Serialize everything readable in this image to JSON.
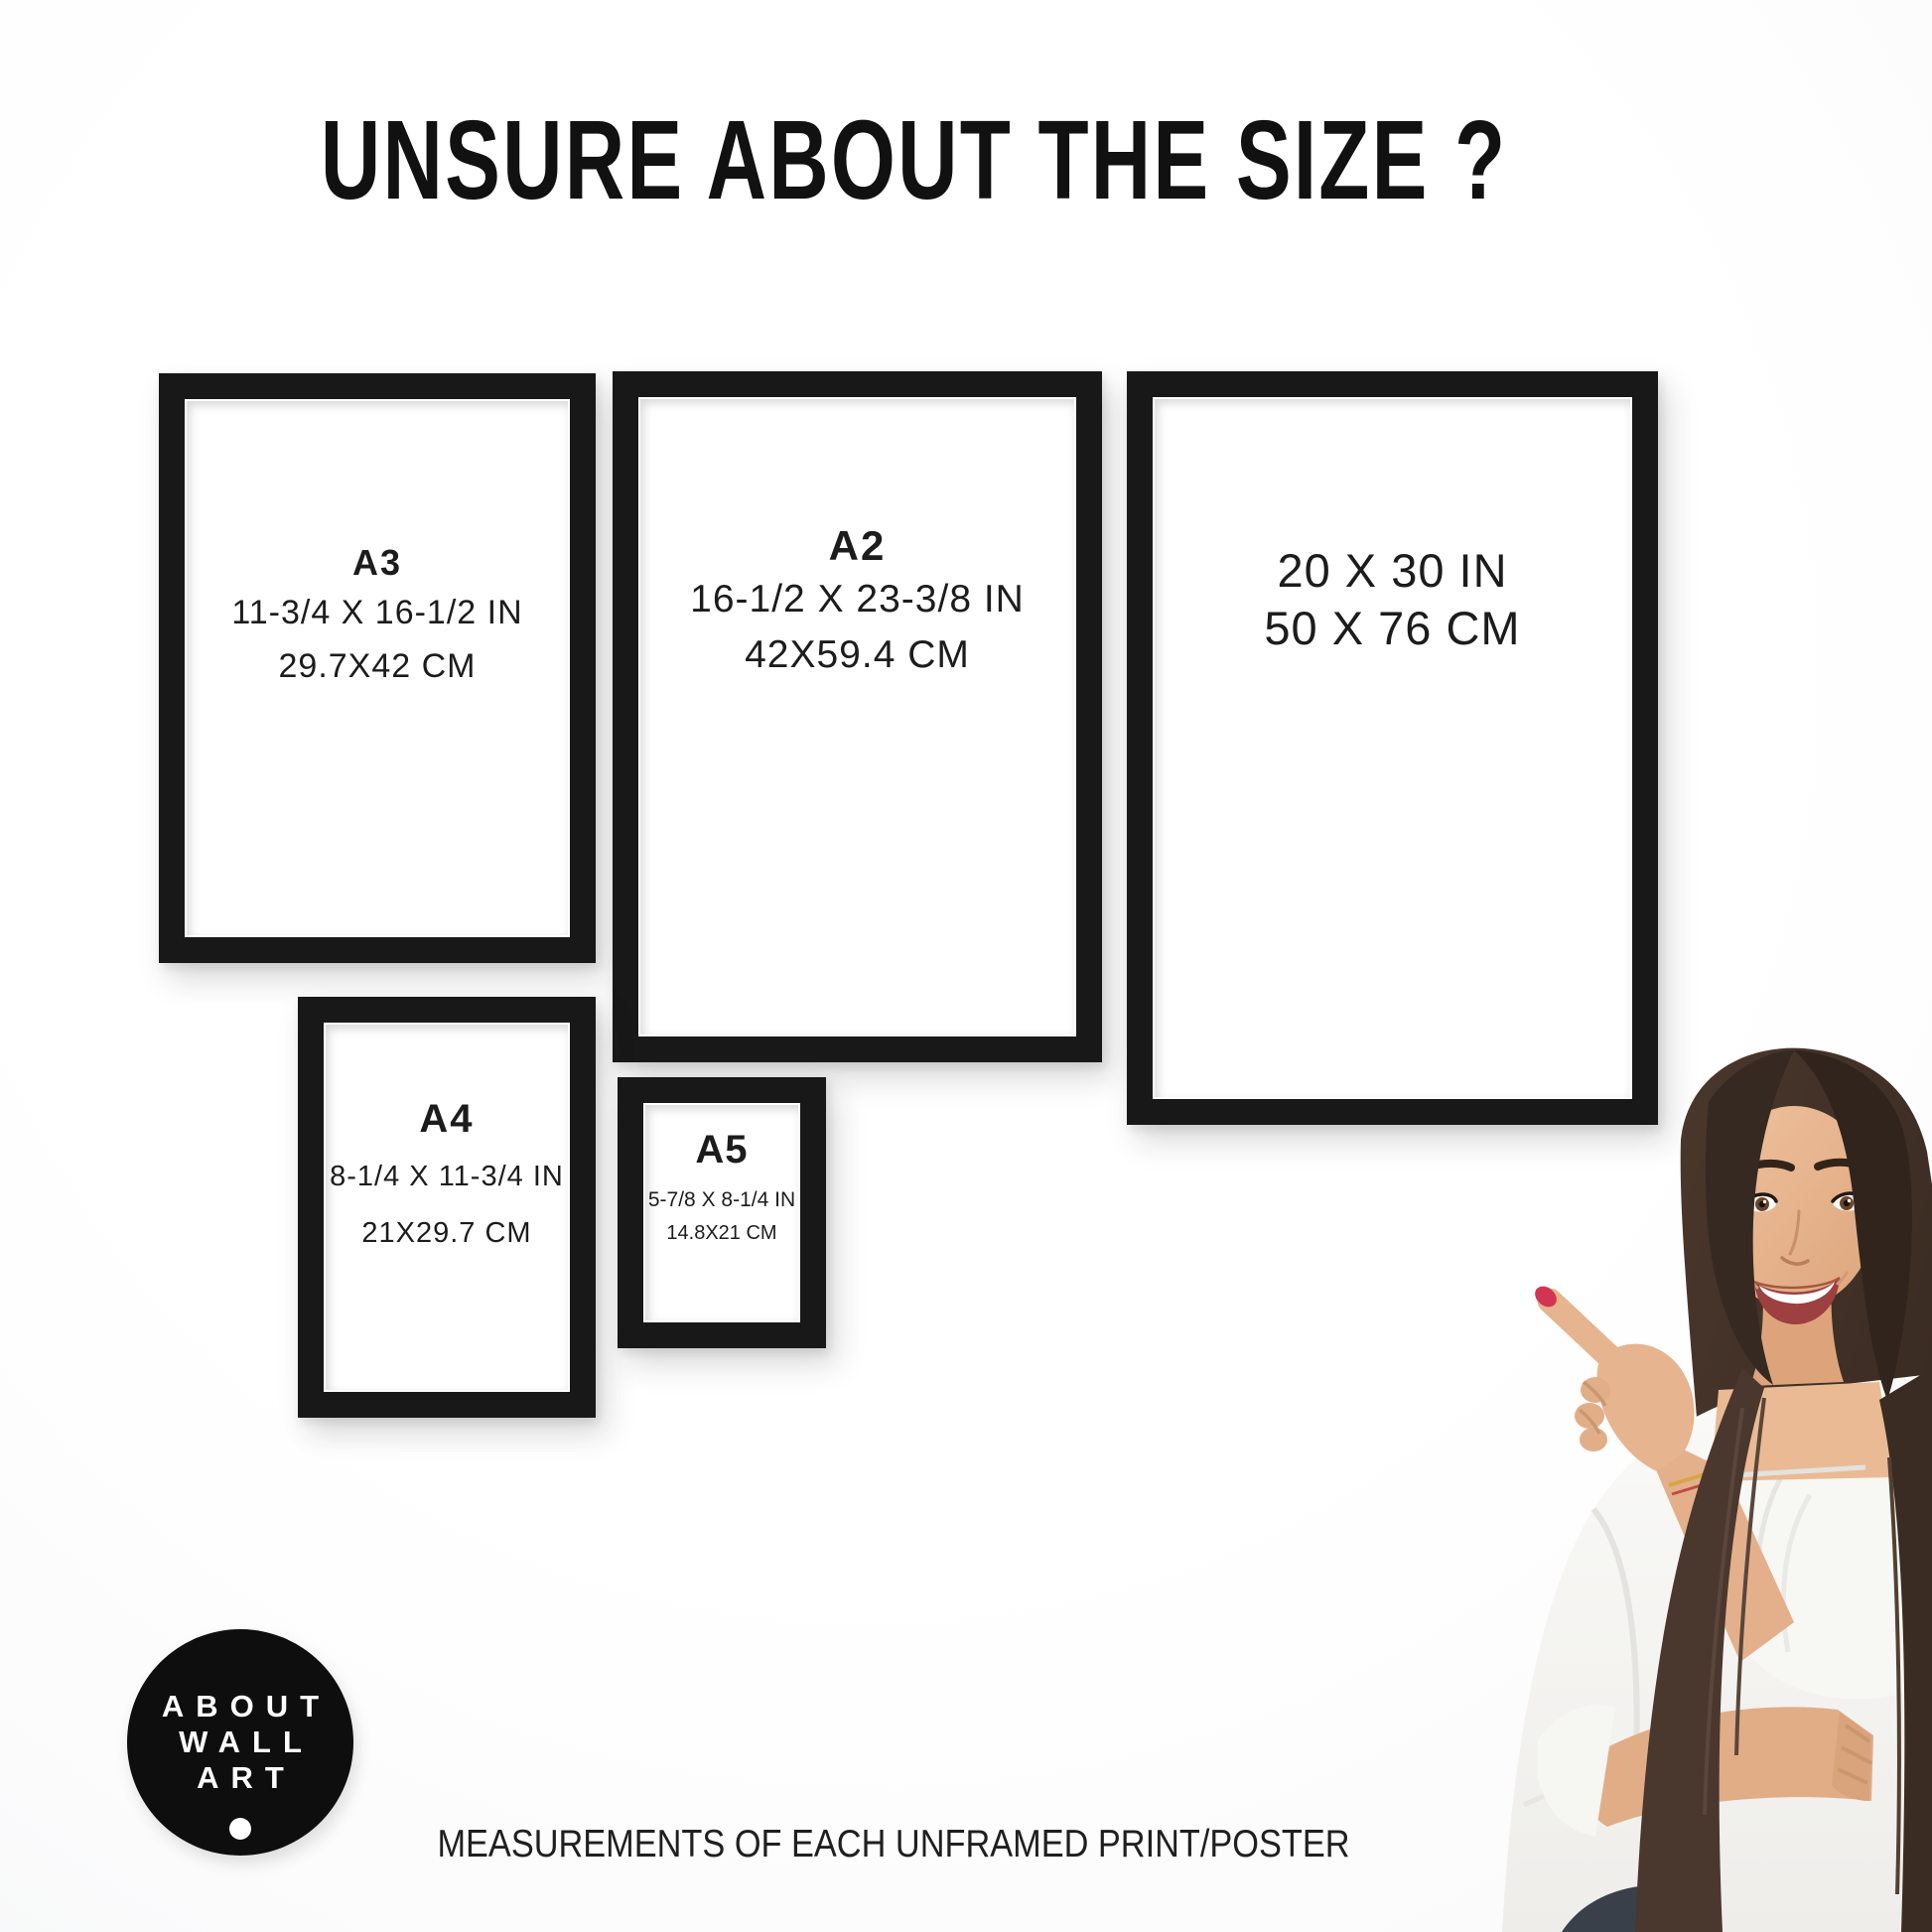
{
  "title": "UNSURE ABOUT THE SIZE ?",
  "caption": "MEASUREMENTS OF EACH UNFRAMED PRINT/POSTER",
  "logo": {
    "lines": [
      "ABOUT",
      "WALL",
      "ART"
    ]
  },
  "frames": [
    {
      "id": "a3",
      "label": "A3",
      "inches": "11-3/4 X 16-1/2 IN",
      "cm": "29.7X42 CM"
    },
    {
      "id": "a2",
      "label": "A2",
      "inches": "16-1/2 X 23-3/8 IN",
      "cm": "42X59.4 CM"
    },
    {
      "id": "20x30",
      "label": "",
      "inches": "20 X 30 IN",
      "cm": "50 X 76 CM"
    },
    {
      "id": "a4",
      "label": "A4",
      "inches": "8-1/4 X 11-3/4 IN",
      "cm": "21X29.7 CM"
    },
    {
      "id": "a5",
      "label": "A5",
      "inches": "5-7/8 X 8-1/4 IN",
      "cm": "14.8X21 CM"
    }
  ],
  "colors": {
    "background": "#ffffff",
    "frame_black": "#181818",
    "text": "#1b1b1b",
    "logo_background": "#0e0e0e",
    "logo_text": "#ffffff",
    "nail_red": "#d23552",
    "hair_brown": "#42312a",
    "skin": "#e6b48e",
    "blouse_white": "#f5f4f2",
    "jeans_dark": "#39404a"
  }
}
